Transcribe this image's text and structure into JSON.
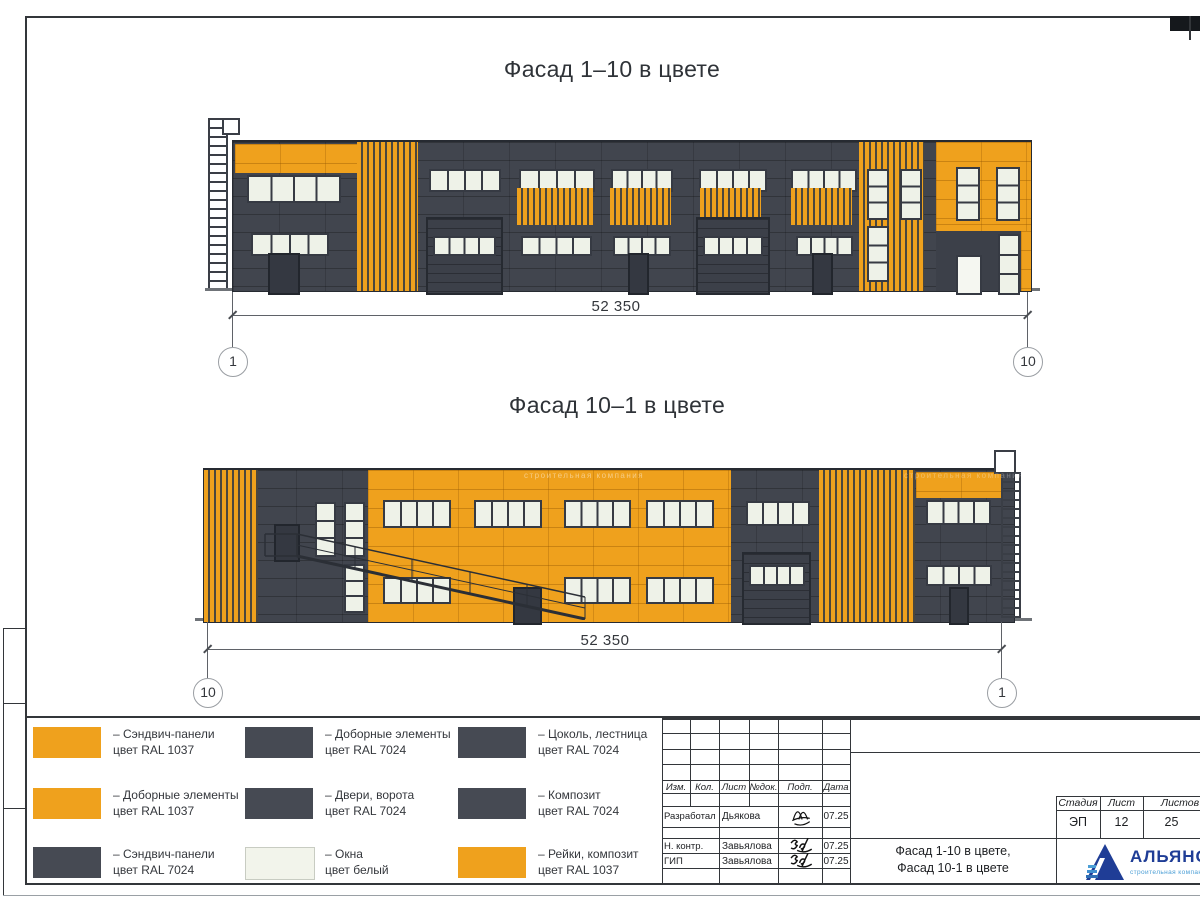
{
  "sheet": {
    "watermark": "строительная компания",
    "drawings": [
      {
        "name": "Фасад 1–10 в цвете",
        "dimension": "52 350",
        "axis_left": "1",
        "axis_right": "10"
      },
      {
        "name": "Фасад 10–1 в цвете",
        "dimension": "52 350",
        "axis_left": "10",
        "axis_right": "1"
      }
    ]
  },
  "legend": {
    "items": [
      {
        "line1": "– Сэндвич-панели",
        "line2": "цвет RAL 1037",
        "color": "#EFA11D"
      },
      {
        "line1": "– Доборные элементы",
        "line2": "цвет RAL 1037",
        "color": "#EFA11D"
      },
      {
        "line1": "– Сэндвич-панели",
        "line2": "цвет RAL 7024",
        "color": "#464A53"
      },
      {
        "line1": "– Доборные элементы",
        "line2": "цвет RAL 7024",
        "color": "#464A53"
      },
      {
        "line1": "– Двери, ворота",
        "line2": "цвет RAL 7024",
        "color": "#464A53"
      },
      {
        "line1": "– Окна",
        "line2": "цвет белый",
        "color": "#F2F4EB"
      },
      {
        "line1": "– Цоколь, лестница",
        "line2": "цвет RAL 7024",
        "color": "#464A53"
      },
      {
        "line1": "– Композит",
        "line2": "цвет RAL 7024",
        "color": "#464A53"
      },
      {
        "line1": "– Рейки, композит",
        "line2": "цвет RAL 1037",
        "color": "#EFA11D"
      }
    ]
  },
  "titleblock": {
    "cols": [
      "Изм.",
      "Кол.",
      "Лист",
      "№док.",
      "Подп.",
      "Дата"
    ],
    "rows": [
      {
        "role": "Разработал",
        "name": "Дьякова",
        "date": "07.25"
      },
      {
        "role": "Н. контр.",
        "name": "Завьялова",
        "date": "07.25"
      },
      {
        "role": "ГИП",
        "name": "Завьялова",
        "date": "07.25"
      }
    ],
    "title_line1": "Фасад 1-10 в цвете,",
    "title_line2": "Фасад 10-1 в цвете",
    "stage_label": "Стадия",
    "sheet_label": "Лист",
    "sheets_label": "Листов",
    "stage": "ЭП",
    "sheet_no": "12",
    "sheets_total": "25",
    "company": "АЛЬЯНС",
    "company_sub": "строительная компания"
  },
  "colors": {
    "orange_ral1037": "#EFA11D",
    "dark_gray_ral7024": "#464A53",
    "window_white": "#F2F4EB",
    "logo_blue": "#1F3D96",
    "logo_light_blue": "#4C9FD6"
  }
}
